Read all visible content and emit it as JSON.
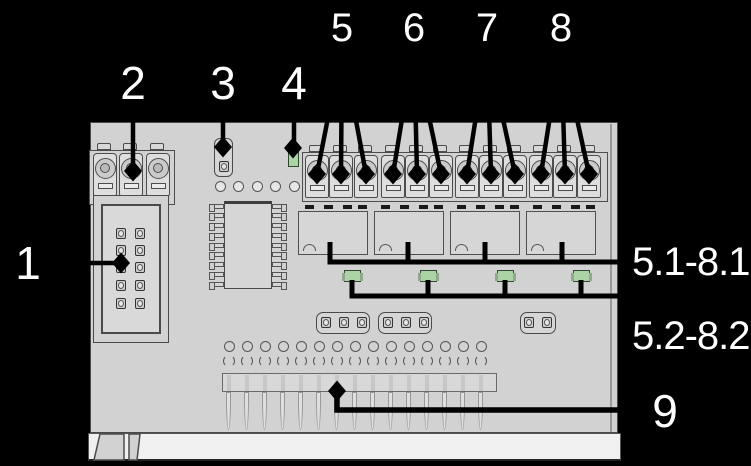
{
  "figure": {
    "kind": "annotated-pcb-diagram",
    "colors": {
      "background": "#000000",
      "board": "#d2d2d2",
      "board_bottom_edge": "#f0f0f0",
      "component_outline": "#4a4a4a",
      "led_green": "#abd3a5",
      "callout_line": "#000000",
      "label_text": "#ffffff"
    }
  },
  "callouts": {
    "top": [
      {
        "label": "5"
      },
      {
        "label": "6"
      },
      {
        "label": "7"
      },
      {
        "label": "8"
      }
    ],
    "mid": [
      {
        "label": "2"
      },
      {
        "label": "3"
      },
      {
        "label": "4"
      }
    ],
    "left": [
      {
        "label": "1"
      }
    ],
    "right": [
      {
        "label": "5.1-8.1"
      },
      {
        "label": "5.2-8.2"
      },
      {
        "label": "9"
      }
    ]
  }
}
